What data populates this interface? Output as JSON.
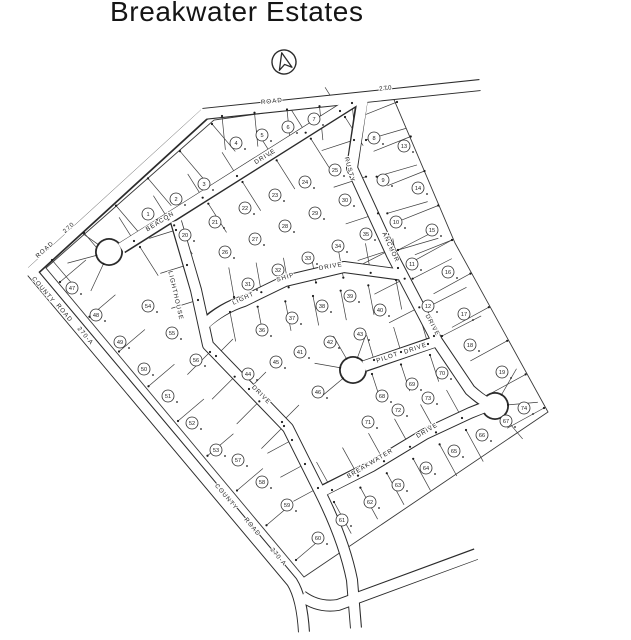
{
  "title": "Breakwater Estates",
  "map": {
    "colors": {
      "line": "#3d3d3d",
      "background": "#ffffff"
    },
    "north_arrow": {
      "x": 284,
      "y": 62
    },
    "road_names": [
      "ROAD 270",
      "COUNTY ROAD 270-A",
      "BEACON DRIVE",
      "LIGHTHOUSE DRIVE",
      "LIGHT SHIP DRIVE",
      "RUSTY ANCHOR DRIVE",
      "PILOT DRIVE",
      "BREAKWATER DRIVE"
    ],
    "street_labels": [
      {
        "text": "ROAD",
        "x": 272,
        "y": 103,
        "rot": -6
      },
      {
        "text": "270",
        "x": 386,
        "y": 90,
        "rot": -6
      },
      {
        "text": "ROAD",
        "x": 46,
        "y": 251,
        "rot": -42
      },
      {
        "text": "270",
        "x": 70,
        "y": 229,
        "rot": -42
      },
      {
        "text": "COUNTY",
        "x": 42,
        "y": 291,
        "rot": 50
      },
      {
        "text": "ROAD",
        "x": 63,
        "y": 314,
        "rot": 50
      },
      {
        "text": "270-A",
        "x": 84,
        "y": 337,
        "rot": 50
      },
      {
        "text": "COUNTY",
        "x": 225,
        "y": 498,
        "rot": 50
      },
      {
        "text": "ROAD",
        "x": 251,
        "y": 528,
        "rot": 50
      },
      {
        "text": "270-A",
        "x": 277,
        "y": 558,
        "rot": 50
      },
      {
        "text": "BEACON",
        "x": 161,
        "y": 223,
        "rot": -32
      },
      {
        "text": "DRIVE",
        "x": 266,
        "y": 158,
        "rot": -32
      },
      {
        "text": "LIGHTHOUSE",
        "x": 174,
        "y": 296,
        "rot": 77
      },
      {
        "text": "DRIVE",
        "x": 260,
        "y": 396,
        "rot": 45
      },
      {
        "text": "LIGHT",
        "x": 244,
        "y": 300,
        "rot": -25
      },
      {
        "text": "SHIP",
        "x": 286,
        "y": 279,
        "rot": -17
      },
      {
        "text": "DRIVE",
        "x": 331,
        "y": 268,
        "rot": -10
      },
      {
        "text": "RUSTY",
        "x": 348,
        "y": 170,
        "rot": 75
      },
      {
        "text": "ANCHOR",
        "x": 389,
        "y": 248,
        "rot": 65
      },
      {
        "text": "DRIVE",
        "x": 431,
        "y": 326,
        "rot": 62
      },
      {
        "text": "PILOT",
        "x": 388,
        "y": 359,
        "rot": -19
      },
      {
        "text": "DRIVE",
        "x": 416,
        "y": 350,
        "rot": -19
      },
      {
        "text": "BREAKWATER",
        "x": 371,
        "y": 465,
        "rot": -31
      },
      {
        "text": "DRIVE",
        "x": 428,
        "y": 432,
        "rot": -31
      }
    ],
    "lots": [
      {
        "n": 1,
        "x": 148,
        "y": 214
      },
      {
        "n": 2,
        "x": 176,
        "y": 199
      },
      {
        "n": 3,
        "x": 204,
        "y": 184
      },
      {
        "n": 4,
        "x": 236,
        "y": 143
      },
      {
        "n": 5,
        "x": 262,
        "y": 135
      },
      {
        "n": 6,
        "x": 288,
        "y": 127
      },
      {
        "n": 7,
        "x": 314,
        "y": 119
      },
      {
        "n": 8,
        "x": 374,
        "y": 138
      },
      {
        "n": 9,
        "x": 383,
        "y": 180
      },
      {
        "n": 10,
        "x": 396,
        "y": 222
      },
      {
        "n": 11,
        "x": 412,
        "y": 264
      },
      {
        "n": 12,
        "x": 428,
        "y": 306
      },
      {
        "n": 13,
        "x": 404,
        "y": 146
      },
      {
        "n": 14,
        "x": 418,
        "y": 188
      },
      {
        "n": 15,
        "x": 432,
        "y": 230
      },
      {
        "n": 16,
        "x": 448,
        "y": 272
      },
      {
        "n": 17,
        "x": 464,
        "y": 314
      },
      {
        "n": 18,
        "x": 470,
        "y": 345
      },
      {
        "n": 19,
        "x": 502,
        "y": 372
      },
      {
        "n": 20,
        "x": 185,
        "y": 235
      },
      {
        "n": 21,
        "x": 215,
        "y": 222
      },
      {
        "n": 22,
        "x": 245,
        "y": 208
      },
      {
        "n": 23,
        "x": 275,
        "y": 195
      },
      {
        "n": 24,
        "x": 305,
        "y": 182
      },
      {
        "n": 25,
        "x": 335,
        "y": 170
      },
      {
        "n": 26,
        "x": 225,
        "y": 252
      },
      {
        "n": 27,
        "x": 255,
        "y": 239
      },
      {
        "n": 28,
        "x": 285,
        "y": 226
      },
      {
        "n": 29,
        "x": 315,
        "y": 213
      },
      {
        "n": 30,
        "x": 345,
        "y": 200
      },
      {
        "n": 31,
        "x": 248,
        "y": 284
      },
      {
        "n": 32,
        "x": 278,
        "y": 270
      },
      {
        "n": 33,
        "x": 308,
        "y": 258
      },
      {
        "n": 34,
        "x": 338,
        "y": 246
      },
      {
        "n": 35,
        "x": 366,
        "y": 234
      },
      {
        "n": 36,
        "x": 262,
        "y": 330
      },
      {
        "n": 37,
        "x": 292,
        "y": 318
      },
      {
        "n": 38,
        "x": 322,
        "y": 306
      },
      {
        "n": 39,
        "x": 350,
        "y": 296
      },
      {
        "n": 40,
        "x": 380,
        "y": 310
      },
      {
        "n": 41,
        "x": 300,
        "y": 352
      },
      {
        "n": 42,
        "x": 330,
        "y": 342
      },
      {
        "n": 43,
        "x": 360,
        "y": 334
      },
      {
        "n": 44,
        "x": 248,
        "y": 374
      },
      {
        "n": 45,
        "x": 276,
        "y": 362
      },
      {
        "n": 46,
        "x": 318,
        "y": 392
      },
      {
        "n": 47,
        "x": 72,
        "y": 288
      },
      {
        "n": 48,
        "x": 96,
        "y": 315
      },
      {
        "n": 49,
        "x": 120,
        "y": 342
      },
      {
        "n": 50,
        "x": 144,
        "y": 369
      },
      {
        "n": 51,
        "x": 168,
        "y": 396
      },
      {
        "n": 52,
        "x": 192,
        "y": 423
      },
      {
        "n": 53,
        "x": 216,
        "y": 450
      },
      {
        "n": 54,
        "x": 148,
        "y": 306
      },
      {
        "n": 55,
        "x": 172,
        "y": 333
      },
      {
        "n": 56,
        "x": 196,
        "y": 360
      },
      {
        "n": 57,
        "x": 238,
        "y": 460
      },
      {
        "n": 58,
        "x": 262,
        "y": 482
      },
      {
        "n": 59,
        "x": 287,
        "y": 505
      },
      {
        "n": 60,
        "x": 318,
        "y": 538
      },
      {
        "n": 61,
        "x": 342,
        "y": 520
      },
      {
        "n": 62,
        "x": 370,
        "y": 502
      },
      {
        "n": 63,
        "x": 398,
        "y": 485
      },
      {
        "n": 64,
        "x": 426,
        "y": 468
      },
      {
        "n": 65,
        "x": 454,
        "y": 451
      },
      {
        "n": 66,
        "x": 482,
        "y": 435
      },
      {
        "n": 67,
        "x": 506,
        "y": 421
      },
      {
        "n": 68,
        "x": 382,
        "y": 396
      },
      {
        "n": 69,
        "x": 412,
        "y": 384
      },
      {
        "n": 70,
        "x": 442,
        "y": 373
      },
      {
        "n": 71,
        "x": 368,
        "y": 422
      },
      {
        "n": 72,
        "x": 398,
        "y": 410
      },
      {
        "n": 73,
        "x": 428,
        "y": 398
      },
      {
        "n": 74,
        "x": 524,
        "y": 408
      }
    ]
  }
}
